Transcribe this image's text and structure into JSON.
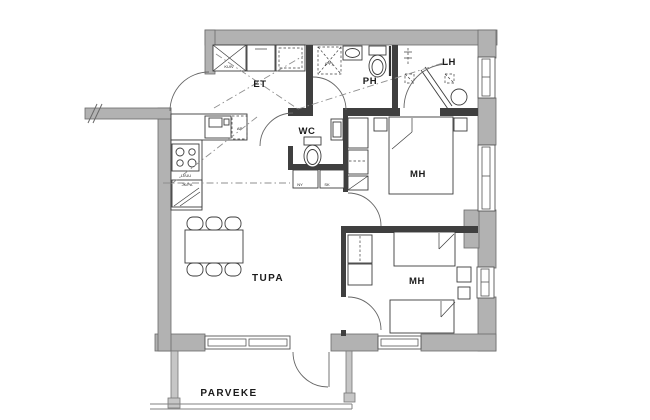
{
  "floor_plan": {
    "room_labels": {
      "et": "ET",
      "ph": "PH",
      "lh": "LH",
      "wc": "WC",
      "bedroom1": "MH",
      "bedroom2": "MH",
      "living_room": "TUPA",
      "balcony": "PARVEKE"
    },
    "fixture_labels": {
      "drying_cabinet": "KUIV",
      "dishwasher": "AP",
      "stove_oven": "LI/UU",
      "fridge_freezer": "JK/PA",
      "washer_reservation": "(PP)",
      "cabinet_left": "NY",
      "cabinet_right": "SK"
    },
    "colors": {
      "background": "#ffffff",
      "exterior_wall_fill": "#b2b2b2",
      "interior_wall": "#3f3f3f",
      "fixture_line": "#3c3c3c",
      "dashdot_line": "#8f8f8f",
      "text": "#1b1b1b"
    }
  }
}
